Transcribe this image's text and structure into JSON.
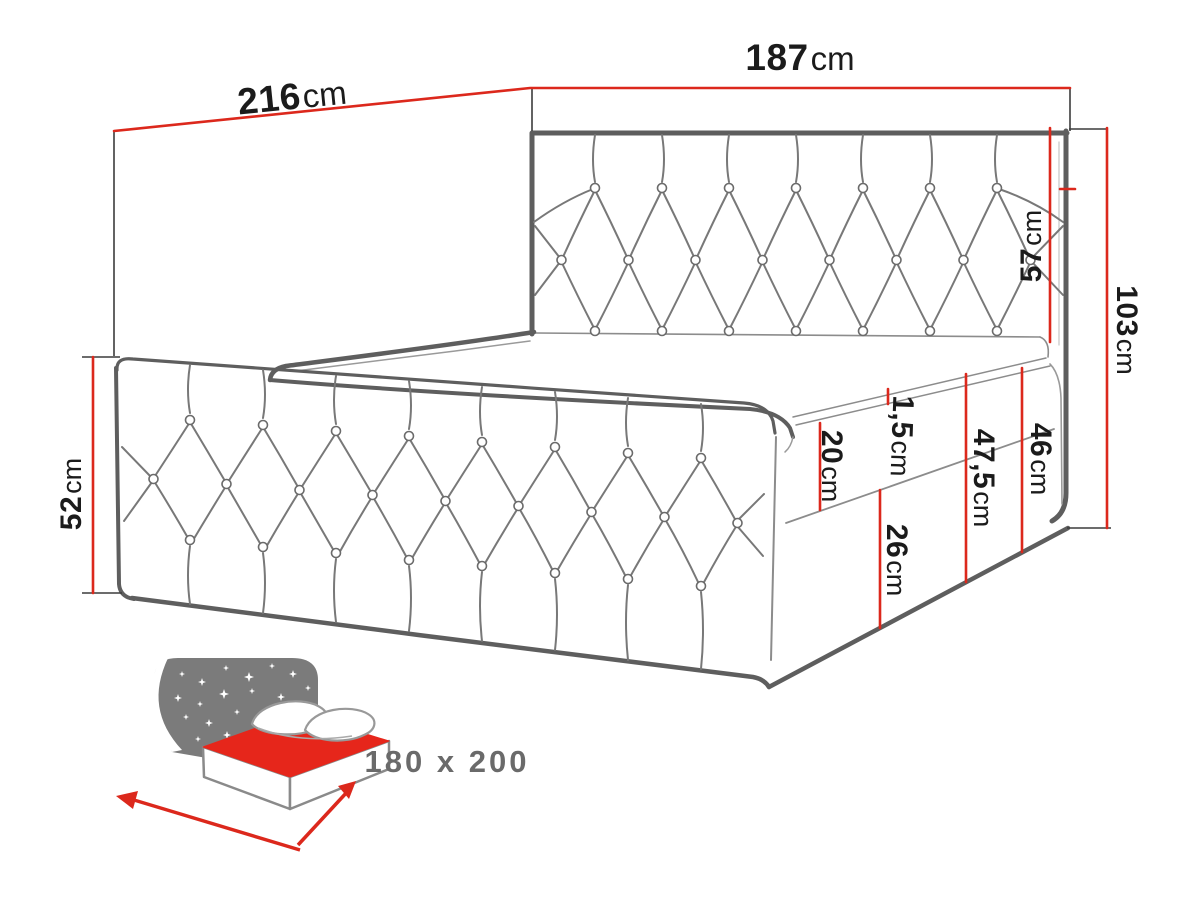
{
  "dimensions": {
    "length": {
      "value": "216",
      "unit": "cm"
    },
    "width": {
      "value": "187",
      "unit": "cm"
    },
    "side_height": {
      "value": "52",
      "unit": "cm"
    },
    "headboard_above": {
      "value": "57",
      "unit": "cm"
    },
    "total_height": {
      "value": "103",
      "unit": "cm"
    },
    "topper_thickness": {
      "value": "1,5",
      "unit": "cm"
    },
    "mattress_height": {
      "value": "20",
      "unit": "cm"
    },
    "lower_box_height": {
      "value": "26",
      "unit": "cm"
    },
    "box_total_height": {
      "value": "46",
      "unit": "cm"
    },
    "upper_section": {
      "value": "47,5",
      "unit": "cm"
    }
  },
  "icon": {
    "size_label": "180 x 200"
  },
  "colors": {
    "dimension_red": "#dc281c",
    "line_gray": "#5e5e5e",
    "icon_gray": "#7b7b7b",
    "label_text": "#1b1b1b",
    "icon_text": "#6a6a6a"
  }
}
